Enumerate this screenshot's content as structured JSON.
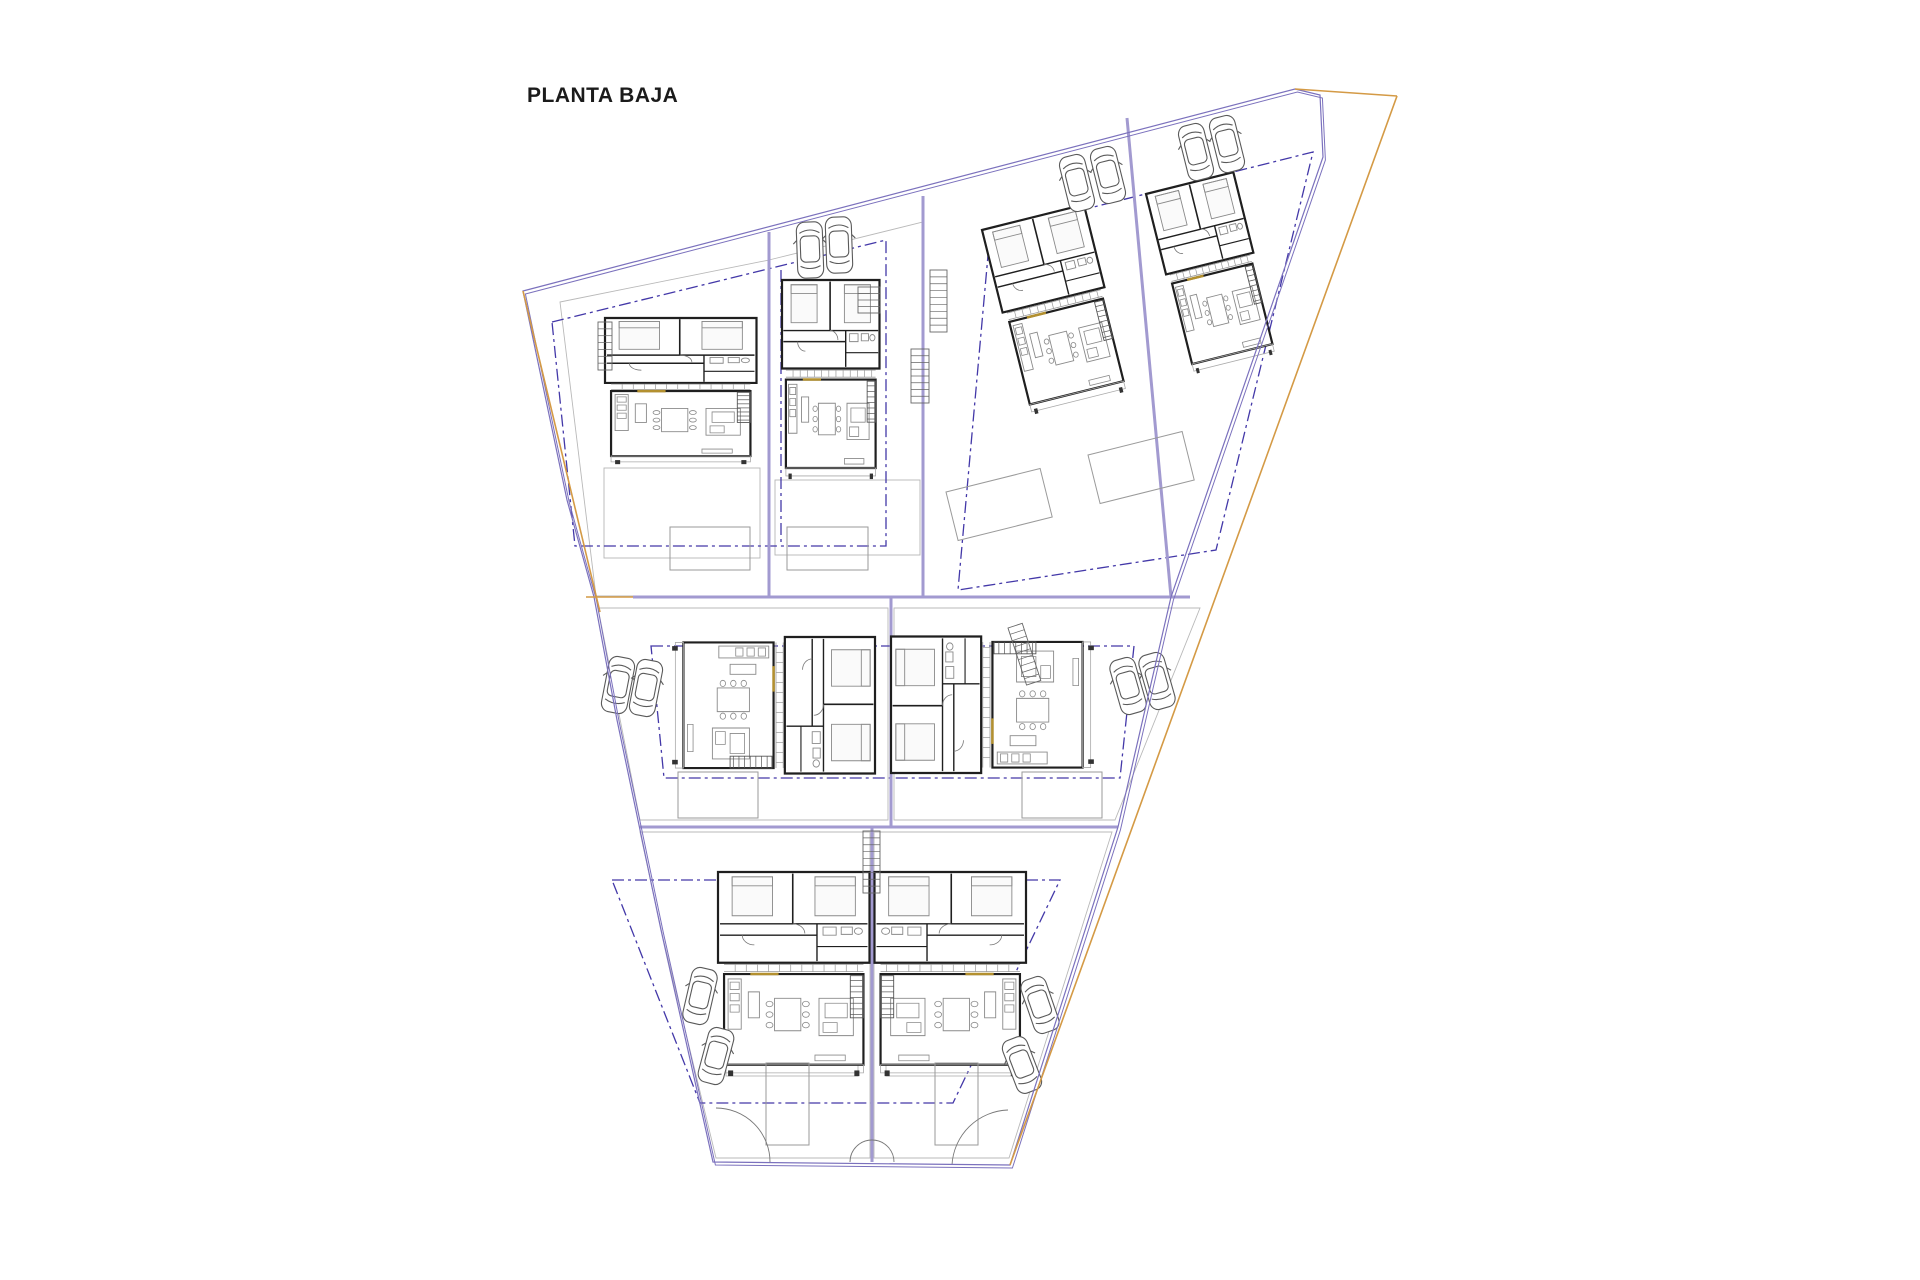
{
  "title": "PLANTA BAJA",
  "palette": {
    "boundary": "#7b71bd",
    "road": "#a29ad0",
    "dash": "#4338a8",
    "orange": "#d49a45",
    "wall": "#1f1f1f",
    "furniture": "#8a8a8a",
    "parcel": "#b9b9b9",
    "gold": "#b3902f",
    "car": "#5a5a5a",
    "pool": "#9a9a9a"
  },
  "site": {
    "boundary_points": "523,291 1295,89 1320,95 1323,157 1220,455 1171,597 1118,827 1010,1165 713,1162 661,930 617,720 594,597 567,500",
    "orange_segments": [
      [
        523,
        291,
        600,
        612
      ],
      [
        586,
        597,
        633,
        597
      ],
      [
        1295,
        89,
        1397,
        96
      ],
      [
        1397,
        96,
        1010,
        1165
      ]
    ],
    "roads": [
      [
        633,
        597,
        1190,
        597
      ],
      [
        640,
        827,
        1118,
        827
      ],
      [
        891,
        597,
        891,
        827
      ],
      [
        872,
        827,
        872,
        1162
      ],
      [
        769,
        232,
        769,
        597
      ],
      [
        923,
        196,
        923,
        597
      ],
      [
        1127,
        118,
        1171,
        597
      ]
    ],
    "parcels": [
      "560,302 769,260 769,596 596,596",
      "769,260 923,222 923,596 769,596",
      "598,608 888,608 888,820 640,820",
      "894,608 1200,608 1115,820 894,820",
      "640,832 870,832 870,1158 716,1158 663,938",
      "874,832 1112,832 1009,1158 874,1158"
    ],
    "setbacks": [
      "552,322 886,240 886,546 575,546",
      "990,233 1313,152 1216,550 958,590",
      "651,646 1134,646 1120,778 664,778",
      "612,880 1060,880 953,1103 700,1103"
    ],
    "setback_lines": [
      [
        781,
        270,
        781,
        546
      ]
    ],
    "gates": [
      "M716 1108 A54 54 0 0 1 770 1162",
      "M850 1162 A22 22 0 0 1 872 1140",
      "M872 1140 A22 22 0 0 1 894 1162",
      "M952 1165 A58 58 0 0 1 1008 1110"
    ]
  },
  "houses": [
    {
      "tx": 605,
      "ty": 318,
      "rot": 0,
      "sx": 1.01,
      "sy": 0.58
    },
    {
      "tx": 782,
      "ty": 280,
      "rot": 0,
      "sx": 0.65,
      "sy": 0.79
    },
    {
      "tx": 982,
      "ty": 230,
      "rot": -14,
      "sx": 0.7,
      "sy": 0.76
    },
    {
      "tx": 1146,
      "ty": 194,
      "rot": -14,
      "sx": 0.6,
      "sy": 0.74
    },
    {
      "tx": 875,
      "ty": 637,
      "rot": 90,
      "sx": 0.91,
      "sy": 0.805
    },
    {
      "tx": 891,
      "ty": 773,
      "rot": -90,
      "sx": 0.91,
      "sy": 0.805
    },
    {
      "tx": 718,
      "ty": 872,
      "rot": 0,
      "sx": 1.01,
      "sy": 0.81
    },
    {
      "tx": 1026,
      "ty": 872,
      "rot": 0,
      "sx": -1.01,
      "sy": 0.81
    }
  ],
  "cars": [
    {
      "x": 810,
      "y": 250,
      "r": -2
    },
    {
      "x": 839,
      "y": 245,
      "r": -2
    },
    {
      "x": 1077,
      "y": 183,
      "r": -14
    },
    {
      "x": 1108,
      "y": 175,
      "r": -14
    },
    {
      "x": 1196,
      "y": 152,
      "r": -14
    },
    {
      "x": 1227,
      "y": 144,
      "r": -14
    },
    {
      "x": 618,
      "y": 685,
      "r": 11
    },
    {
      "x": 646,
      "y": 688,
      "r": 11
    },
    {
      "x": 1128,
      "y": 686,
      "r": -16
    },
    {
      "x": 1157,
      "y": 681,
      "r": -16
    },
    {
      "x": 700,
      "y": 996,
      "r": 13
    },
    {
      "x": 716,
      "y": 1056,
      "r": 15
    },
    {
      "x": 1040,
      "y": 1005,
      "r": -19
    },
    {
      "x": 1022,
      "y": 1065,
      "r": -21
    }
  ],
  "pools": [
    {
      "x": 670,
      "y": 527,
      "w": 80,
      "h": 43,
      "r": 0
    },
    {
      "x": 787,
      "y": 527,
      "w": 81,
      "h": 43,
      "r": 0
    },
    {
      "x": 946,
      "y": 492,
      "w": 97,
      "h": 50,
      "r": -14
    },
    {
      "x": 1088,
      "y": 455,
      "w": 97,
      "h": 50,
      "r": -14
    },
    {
      "x": 678,
      "y": 772,
      "w": 80,
      "h": 46,
      "r": 0
    },
    {
      "x": 1022,
      "y": 772,
      "w": 80,
      "h": 46,
      "r": 0
    },
    {
      "x": 766,
      "y": 1063,
      "w": 43,
      "h": 82,
      "r": 0
    },
    {
      "x": 935,
      "y": 1063,
      "w": 43,
      "h": 82,
      "r": 0
    }
  ],
  "ladders": [
    {
      "x": 930,
      "y": 270,
      "w": 17,
      "h": 62,
      "r": 0
    },
    {
      "x": 911,
      "y": 349,
      "w": 18,
      "h": 54,
      "r": 0
    },
    {
      "x": 863,
      "y": 831,
      "w": 17,
      "h": 62,
      "r": 0
    },
    {
      "x": 1008,
      "y": 628,
      "w": 15,
      "h": 60,
      "r": -18
    },
    {
      "x": 598,
      "y": 322,
      "w": 14,
      "h": 48,
      "r": 0
    },
    {
      "x": 858,
      "y": 287,
      "w": 22,
      "h": 26,
      "r": 0
    }
  ],
  "terraces": [
    [
      604,
      468,
      156,
      90
    ],
    [
      775,
      480,
      145,
      75
    ],
    [
      726,
      1042,
      132,
      34
    ],
    [
      886,
      1042,
      132,
      34
    ]
  ]
}
